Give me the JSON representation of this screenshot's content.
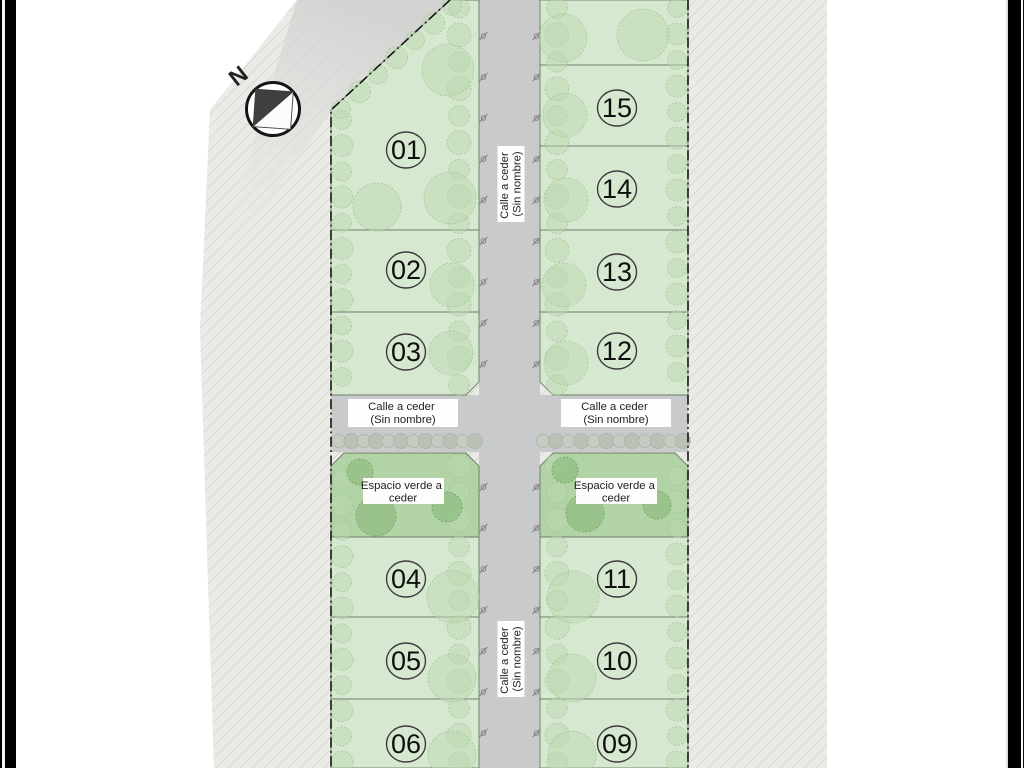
{
  "compass": {
    "north_letter": "N"
  },
  "streets": {
    "labels": {
      "horizontal_left": {
        "line1": "Calle a ceder",
        "line2": "(Sin nombre)"
      },
      "horizontal_right": {
        "line1": "Calle a ceder",
        "line2": "(Sin nombre)"
      },
      "vertical_top": {
        "line1": "Calle a ceder",
        "line2": "(Sin nombre)"
      },
      "vertical_bottom": {
        "line1": "Calle a ceder",
        "line2": "(Sin nombre)"
      }
    }
  },
  "green_spaces": {
    "left": {
      "line1": "Espacio verde a",
      "line2": "ceder"
    },
    "right": {
      "line1": "Espacio verde a",
      "line2": "ceder"
    }
  },
  "lots": [
    {
      "number": "01"
    },
    {
      "number": "02"
    },
    {
      "number": "03"
    },
    {
      "number": "04"
    },
    {
      "number": "05"
    },
    {
      "number": "06"
    },
    {
      "number": "09"
    },
    {
      "number": "10"
    },
    {
      "number": "11"
    },
    {
      "number": "12"
    },
    {
      "number": "13"
    },
    {
      "number": "14"
    },
    {
      "number": "15"
    }
  ],
  "colors": {
    "lot_fill": "#d7e8d0",
    "green_space_fill": "#b1d3a5",
    "street_fill": "#c9cacb",
    "surrounding_land": "#eaebe6",
    "hatch_line": "#d9dbd3",
    "boundary_line": "#141414",
    "tree": "#bcd8b1",
    "tree_dark": "#8fbc80",
    "hedge": "#c6cbc2",
    "label_background": "#ffffff",
    "text": "#1e1e1e"
  }
}
